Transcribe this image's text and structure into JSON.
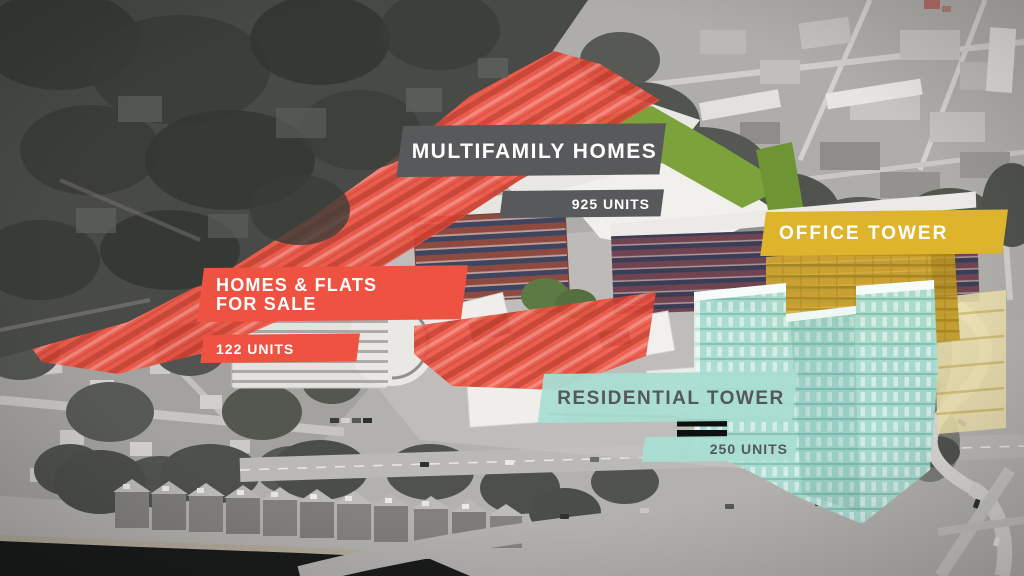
{
  "colors": {
    "label_gray": "#58595b",
    "red": "#ee5342",
    "yellow": "#deb42d",
    "teal": "#a9ddd3",
    "teal_text": "#54575b",
    "green": "#7ca23b"
  },
  "labels": {
    "multifamily_homes": {
      "title": "MULTIFAMILY HOMES",
      "units": "925 UNITS"
    },
    "office_tower": {
      "title": "OFFICE TOWER"
    },
    "homes_flats_for_sale": {
      "title_line1": "HOMES & FLATS",
      "title_line2": "FOR SALE",
      "units": "122 UNITS"
    },
    "residential_tower": {
      "title": "RESIDENTIAL TOWER",
      "units": "250 UNITS"
    }
  }
}
